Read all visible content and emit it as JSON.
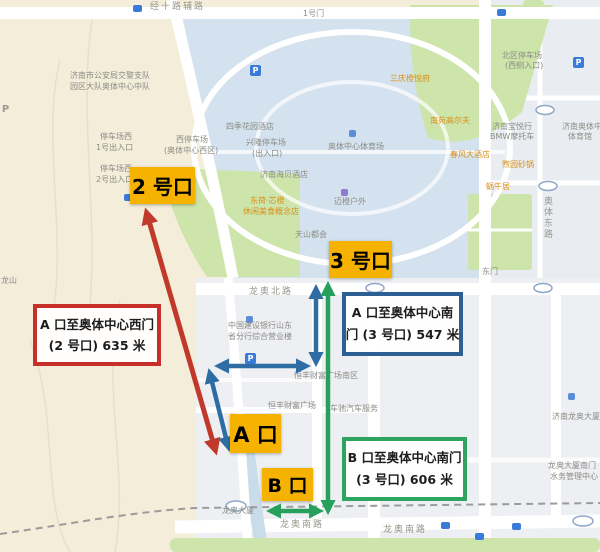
{
  "overlay": {
    "exit_markers": [
      {
        "text": "2 号口"
      },
      {
        "text": "3 号口"
      },
      {
        "text": "A 口"
      },
      {
        "text": "B 口"
      }
    ],
    "distance_notes": [
      {
        "line1": "A 口至奥体中心西门",
        "line2": "(2 号口) 635 米",
        "border_color": "#c62f2a"
      },
      {
        "line1": "A 口至奥体中心南",
        "line2": "门 (3 号口) 547 米",
        "border_color": "#2e5f94"
      },
      {
        "line1": "B 口至奥体中心南门",
        "line2": "(3 号口) 606 米",
        "border_color": "#2fa45e"
      }
    ]
  },
  "map": {
    "parking_glyph": "P",
    "labels": [
      "经十路辅路",
      "龙奥北路",
      "龙奥南路",
      "龙奥南路",
      "奥体东路",
      "1号门",
      "济南市公安局交警支队",
      "园区大队奥体中心中队",
      "停车场西",
      "1号出入口",
      "停车场西",
      "2号出入口",
      "西停车场",
      "(奥体中心西区)",
      "兴隆停车场",
      "(出入口)",
      "奥体中心体育场",
      "济南海贝酒店",
      "迈橙户外",
      "天山都会",
      "北区停车场",
      "(西侧入口)",
      "济南宝悦行",
      "BMW摩托车",
      "济南奥体中心",
      "体育馆",
      "中国建设银行山东",
      "省分行综合营业楼",
      "恒丰财富广场南区",
      "恒丰财富广场",
      "车驰汽车服务",
      "龙奥大厦",
      "济南龙奥大厦",
      "龙奥大厦南门",
      "水务管理中心",
      "龙山",
      "东门",
      "三庆橙悦府",
      "南苑高尔夫",
      "春风大酒店",
      "煦园砂锅",
      "蜗牛居",
      "东荷·芯橙",
      "休闲美食概念店",
      "四季花园酒店"
    ]
  },
  "colors": {
    "exit_marker_bg": "#f5b201",
    "red_route": "#c0392b",
    "blue_route": "#2e6da4",
    "green_route": "#27a05e",
    "water": "#d3e2ee",
    "park_green": "#cde4ab",
    "terrain": "#f4edda"
  }
}
